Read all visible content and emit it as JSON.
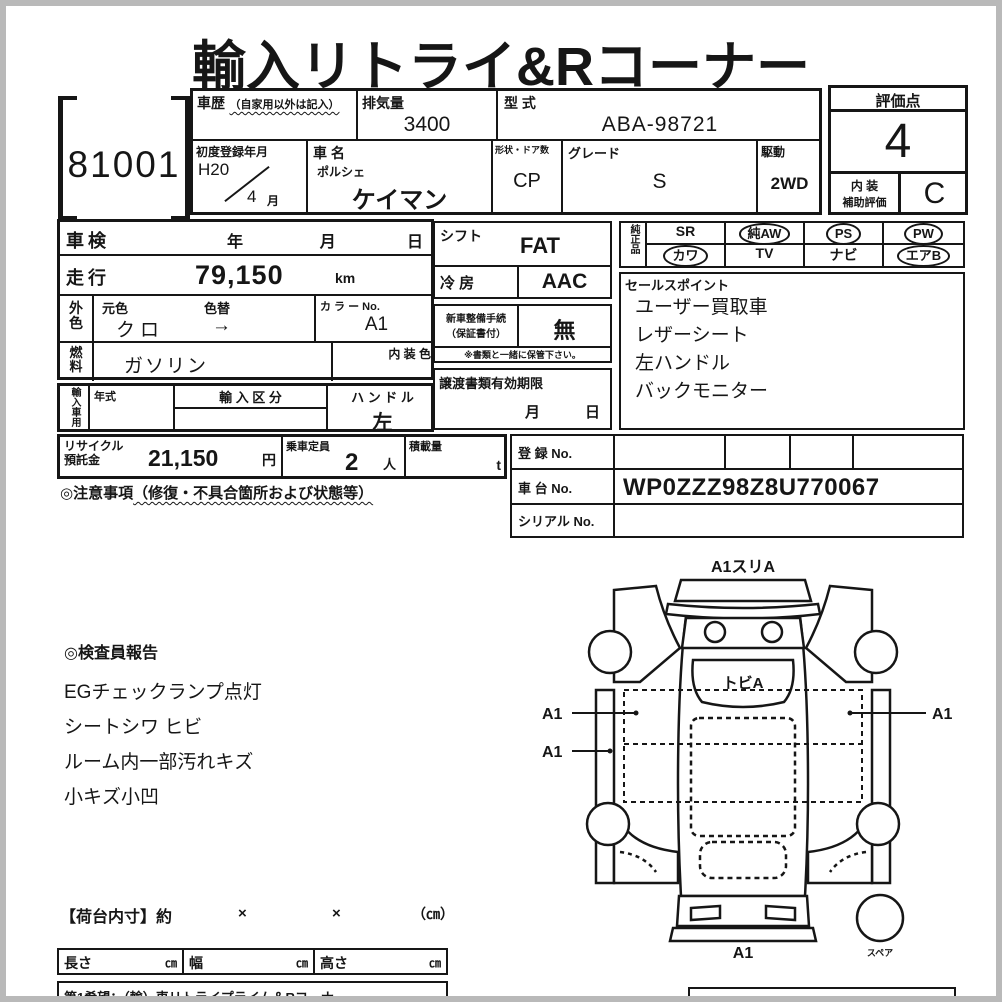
{
  "title": "輸入リトライ&Rコーナー",
  "lot": {
    "number": "81001"
  },
  "vehicle": {
    "history_label": "車歴",
    "history_note": "（自家用以外は記入）",
    "displacement_label": "排気量",
    "displacement": "3400",
    "model_code_label": "型 式",
    "model_code": "ABA-98721",
    "first_reg_label": "初度登録年月",
    "first_reg_year": "H20",
    "first_reg_month": "4",
    "first_reg_month_suffix": "月",
    "name_label": "車 名",
    "maker": "ポルシェ",
    "name": "ケイマン",
    "shape_label": "形状・ドア数",
    "shape": "CP",
    "grade_label": "グレード",
    "grade": "S",
    "drive_label": "駆動",
    "drive": "2WD"
  },
  "score": {
    "label": "評価点",
    "value": "4",
    "interior_label1": "内 装",
    "interior_label2": "補助評価",
    "interior_value": "C"
  },
  "details": {
    "shaken_label": "車検",
    "year": "年",
    "month": "月",
    "day": "日",
    "mileage_label": "走行",
    "mileage": "79,150",
    "mileage_unit": "km",
    "ext_color_label": "外色",
    "base_color_label": "元色",
    "repaint_label": "色替",
    "base_color": "クロ",
    "repaint_arrow": "→",
    "color_no_label": "カ ラ ー No.",
    "color_no": "A1",
    "fuel_label": "燃料",
    "fuel": "ガソリン",
    "interior_color_label": "内 装 色",
    "import_label": "輸入車用",
    "model_year_label": "年式",
    "import_class_label": "輸 入 区 分",
    "handle_label": "ハ ン ド ル",
    "handle": "左"
  },
  "options": {
    "shift_label": "シフト",
    "shift": "FAT",
    "ac_label": "冷 房",
    "ac": "AAC",
    "prep_label1": "新車整備手続",
    "prep_label2": "（保証書付）",
    "prep": "無",
    "keep_note": "※書類と一緒に保管下さい。",
    "transfer_label": "譲渡書類有効期限",
    "transfer_month": "月",
    "transfer_day": "日"
  },
  "equipment": {
    "label": "純正品",
    "items": [
      {
        "label": "SR",
        "circled": false
      },
      {
        "label": "純AW",
        "circled": true
      },
      {
        "label": "PS",
        "circled": true
      },
      {
        "label": "PW",
        "circled": true
      },
      {
        "label": "カワ",
        "circled": true
      },
      {
        "label": "TV",
        "circled": false
      },
      {
        "label": "ナビ",
        "circled": false
      },
      {
        "label": "エアB",
        "circled": true
      }
    ]
  },
  "sales_points": {
    "label": "セールスポイント",
    "items": [
      "ユーザー買取車",
      "レザーシート",
      "左ハンドル",
      "バックモニター"
    ]
  },
  "recycle": {
    "label1": "リサイクル",
    "label2": "預託金",
    "amount": "21,150",
    "unit": "円",
    "seats_label": "乗車定員",
    "seats": "2",
    "seats_unit": "人",
    "load_label": "積載量",
    "load_unit": "t"
  },
  "notice": {
    "prefix": "◎注意事項",
    "detail": "（修復・不具合箇所および状態等）"
  },
  "registration": {
    "reg_label": "登 録 No.",
    "reg_no": "",
    "chassis_label": "車 台 No.",
    "chassis_no": "WP0ZZZ98Z8U770067",
    "serial_label": "シリアル No.",
    "serial_no": ""
  },
  "inspector": {
    "heading": "◎検査員報告",
    "items": [
      "EGチェックランプ点灯",
      "シートシワ ヒビ",
      "ルーム内一部汚れキズ",
      "小キズ小凹"
    ]
  },
  "diagram": {
    "front_note": "A1スリA",
    "windshield_note": "トビA",
    "left_note1": "A1",
    "left_note2": "A1",
    "right_note": "A1",
    "rear_note": "A1",
    "spare_label": "スペア"
  },
  "cargo": {
    "heading": "【荷台内寸】約",
    "times1": "×",
    "times2": "×",
    "unit_note": "（㎝）",
    "length_label": "長さ",
    "width_label": "幅",
    "height_label": "高さ",
    "unit": "㎝"
  },
  "footer": {
    "request": "第1希望：（輸）車リトライプライム＆Rコーナー"
  }
}
